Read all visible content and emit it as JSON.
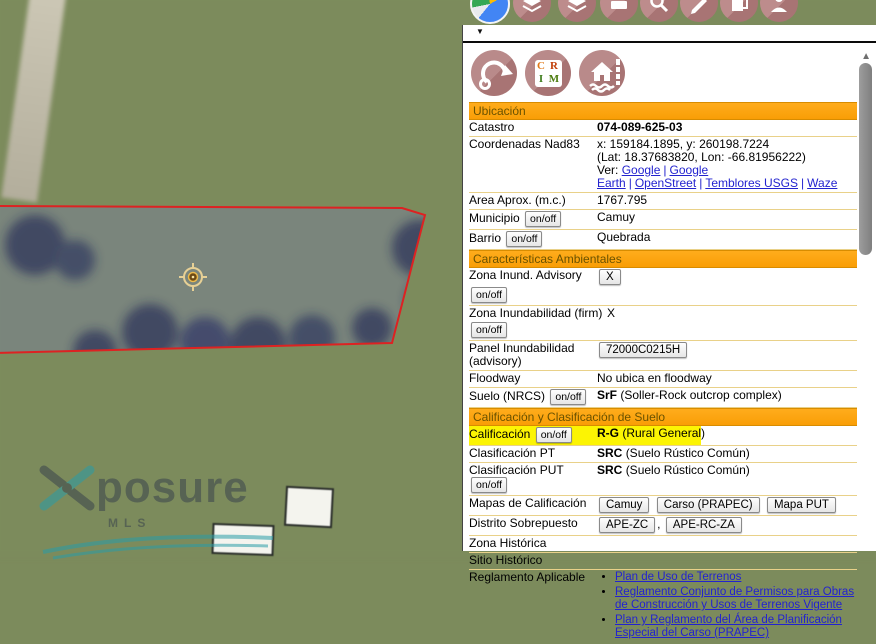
{
  "ui": {
    "dropdown_arrow": "▼",
    "scroll_up_arrow": "▲",
    "onoff": "on/off",
    "pipe": "|",
    "comma": ","
  },
  "watermark": {
    "word": "posure",
    "sub": "MLS"
  },
  "icons": {
    "crim": {
      "l1": "C",
      "l2": "R",
      "l3": "I",
      "l4": "M"
    }
  },
  "sections": {
    "ubicacion": "Ubicación",
    "ambientales": "Características Ambientales",
    "calificacion": "Calificación y Clasificación de Suelo"
  },
  "rows": {
    "catastro": {
      "label": "Catastro",
      "value": "074-089-625-03"
    },
    "coordenadas": {
      "label": "Coordenadas Nad83",
      "xy": "x: 159184.1895, y: 260198.7224",
      "latlon": "(Lat: 18.37683820, Lon: -66.81956222)",
      "ver": "Ver:",
      "links": [
        "Google",
        "Google Earth",
        "OpenStreet",
        "Temblores USGS",
        "Waze"
      ]
    },
    "area": {
      "label": "Area Aprox. (m.c.)",
      "value": "1767.795"
    },
    "municipio": {
      "label": "Municipio",
      "value": "Camuy"
    },
    "barrio": {
      "label": "Barrio",
      "value": "Quebrada"
    },
    "zona_advisory": {
      "label": "Zona Inund. Advisory",
      "value": "X"
    },
    "zona_firm": {
      "label": "Zona Inundabilidad (firm)",
      "value": "X"
    },
    "panel_inund": {
      "label": "Panel Inundabilidad (advisory)",
      "value": "72000C0215H"
    },
    "floodway": {
      "label": "Floodway",
      "value": "No ubica en floodway"
    },
    "suelo": {
      "label": "Suelo (NRCS)",
      "code": "SrF",
      "desc": "(Soller-Rock outcrop complex)"
    },
    "calificacion": {
      "label": "Calificación",
      "code": "R-G",
      "desc": "(Rural General)"
    },
    "clas_pt": {
      "label": "Clasificación PT",
      "code": "SRC",
      "desc": "(Suelo Rústico Común)"
    },
    "clas_put": {
      "label": "Clasificación PUT",
      "code": "SRC",
      "desc": "(Suelo Rústico Común)"
    },
    "mapas": {
      "label": "Mapas de Calificación",
      "buttons": [
        "Camuy",
        "Carso (PRAPEC)",
        "Mapa PUT"
      ]
    },
    "distrito": {
      "label": "Distrito Sobrepuesto",
      "buttons": [
        "APE-ZC",
        "APE-RC-ZA"
      ]
    },
    "zona_historica": {
      "label": "Zona Histórica"
    },
    "sitio_historico": {
      "label": "Sitio Histórico"
    },
    "reglamento": {
      "label": "Reglamento Aplicable",
      "items": [
        "Plan de Uso de Terrenos",
        "Reglamento Conjunto de Permisos para Obras de Construcción y Usos de Terrenos Vigente",
        "Plan y Reglamento del Área de Planificación Especial del Carso (PRAPEC)"
      ]
    }
  }
}
